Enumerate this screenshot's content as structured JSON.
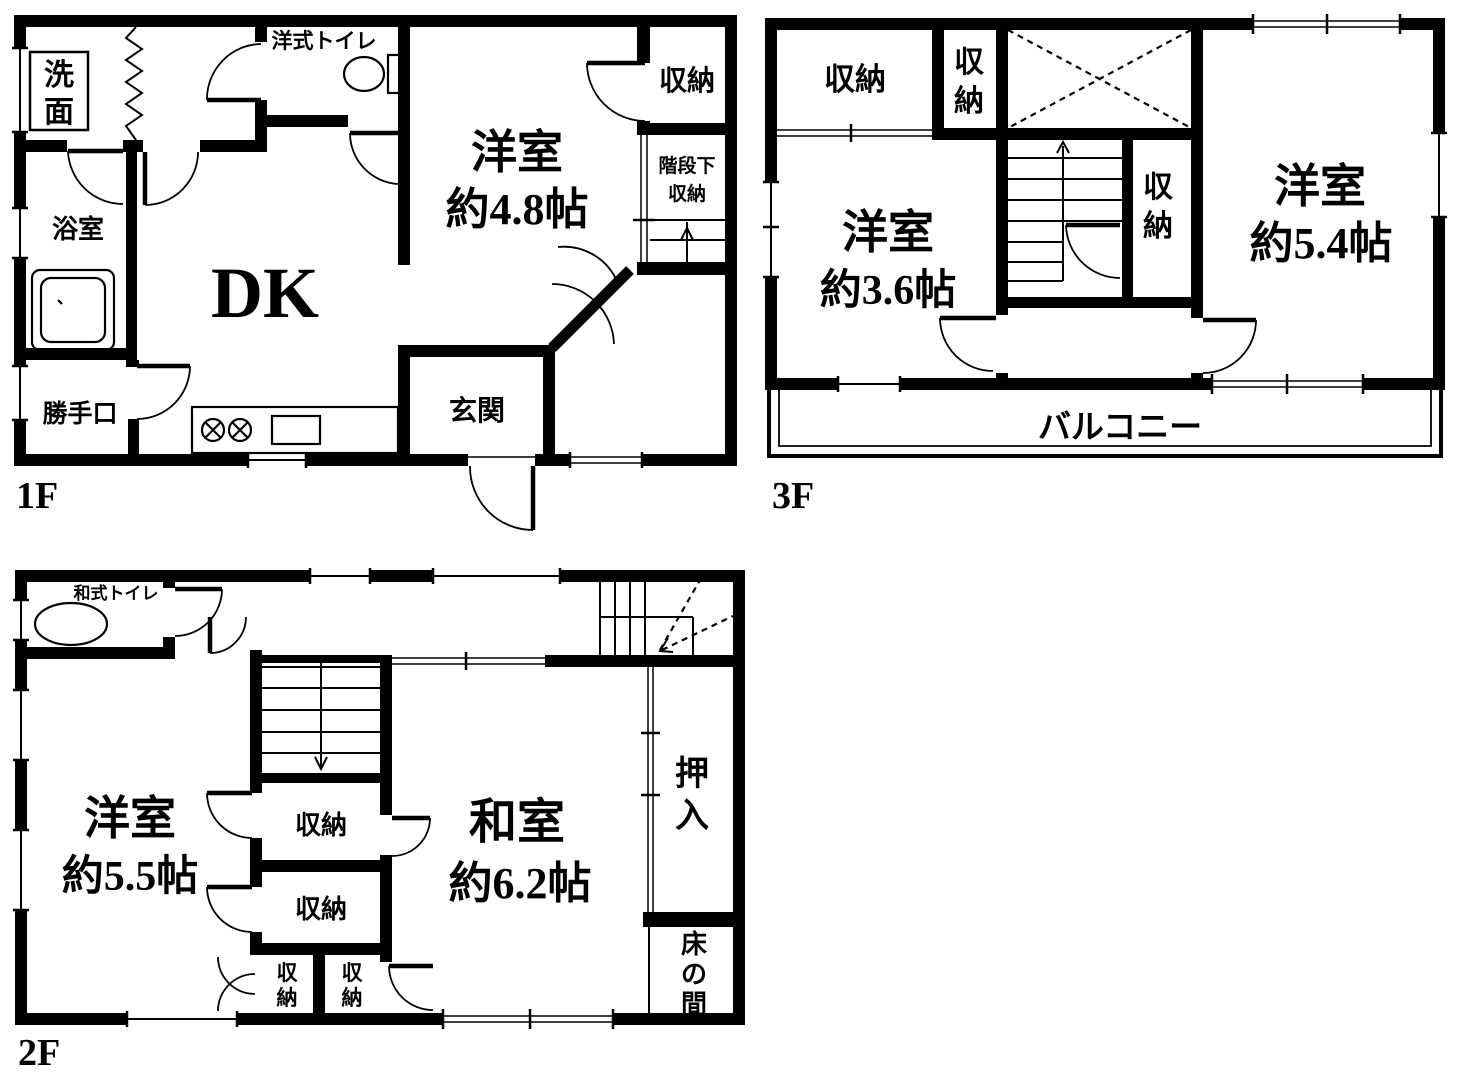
{
  "colors": {
    "line": "#000000",
    "background": "#ffffff"
  },
  "floors": {
    "f1": {
      "label": "1F",
      "rooms": {
        "senmen": "洗面",
        "yokushitsu": "浴室",
        "katteguchi": "勝手口",
        "dk": "DK",
        "western_toilet": "洋式トイレ",
        "yoshitsu_name": "洋室",
        "yoshitsu_size": "約4.8帖",
        "shuno": "収納",
        "under_stairs_1": "階段下",
        "under_stairs_2": "収納",
        "genkan": "玄関"
      }
    },
    "f2": {
      "label": "2F",
      "rooms": {
        "japanese_toilet": "和式トイレ",
        "yoshitsu_name": "洋室",
        "yoshitsu_size": "約5.5帖",
        "shuno_upper": "収納",
        "shuno_lower": "収納",
        "shuno_small_left": "収納",
        "shuno_small_right": "収納",
        "washitsu_name": "和室",
        "washitsu_size": "約6.2帖",
        "oshiire": "押入",
        "tokonoma": "床の間"
      }
    },
    "f3": {
      "label": "3F",
      "rooms": {
        "shuno_big": "収納",
        "shuno_small": "収納",
        "shuno_mid": "収納",
        "yoshitsu_a_name": "洋室",
        "yoshitsu_a_size": "約3.6帖",
        "yoshitsu_b_name": "洋室",
        "yoshitsu_b_size": "約5.4帖",
        "balcony": "バルコニー"
      }
    }
  }
}
